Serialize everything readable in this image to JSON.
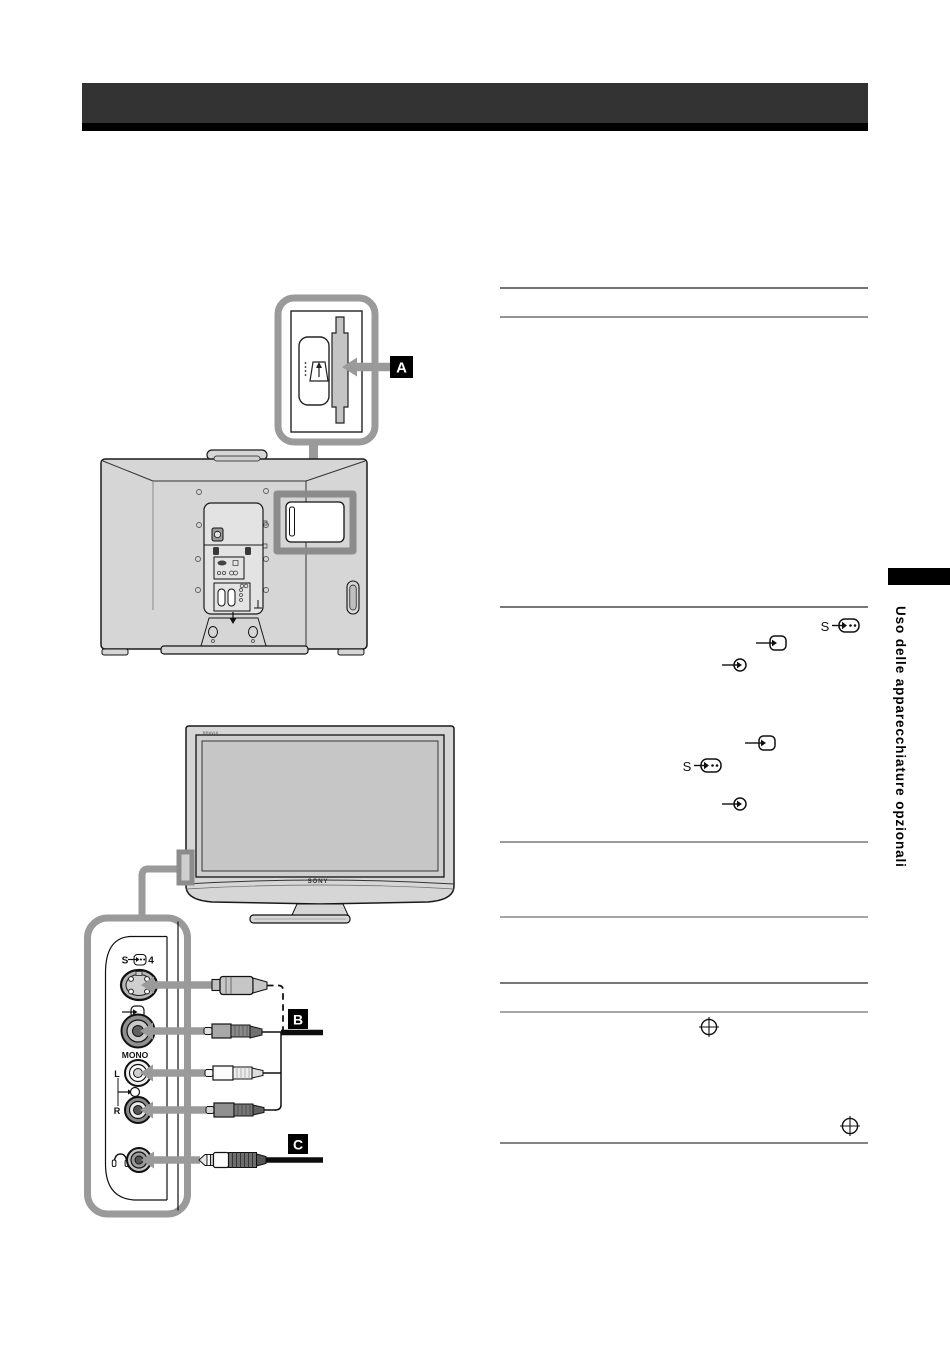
{
  "header": {
    "bar_color": "#333333",
    "strip_color": "#000000"
  },
  "sidebar": {
    "section_title": "Uso delle apparecchiature opzionali",
    "tab_color": "#000000"
  },
  "callout_labels": {
    "a": "A",
    "b": "B",
    "c": "C"
  },
  "tv_front": {
    "brand_logo": "SONY",
    "model_logo": "BRAVIA"
  },
  "side_panel": {
    "svideo_prefix": "S",
    "svideo_number": "4",
    "mono_label": "MONO",
    "audio_left_label": "L",
    "audio_right_label": "R"
  },
  "inline_icons": {
    "svideo_letter": "S",
    "names": [
      "svideo-input-icon",
      "video-input-icon",
      "audio-input-icon",
      "page-reference-icon"
    ]
  },
  "diagram_icons": {
    "names": [
      "cam-module-icon",
      "cam-insert-icon",
      "headphones-icon",
      "svideo-jack",
      "video-jack",
      "audio-left-jack",
      "audio-right-jack",
      "headphone-jack"
    ]
  },
  "colors": {
    "callout_frame": "#9a9a9a",
    "highlight_frame": "#8c8c8c",
    "tv_body_fill": "#d6d6d6",
    "screen_fill": "#c6c6c6",
    "line_art": "#1a1a1a",
    "label_bg": "#000000",
    "label_text": "#ffffff",
    "rule_dark": "#454545",
    "rule_light": "#939393"
  }
}
